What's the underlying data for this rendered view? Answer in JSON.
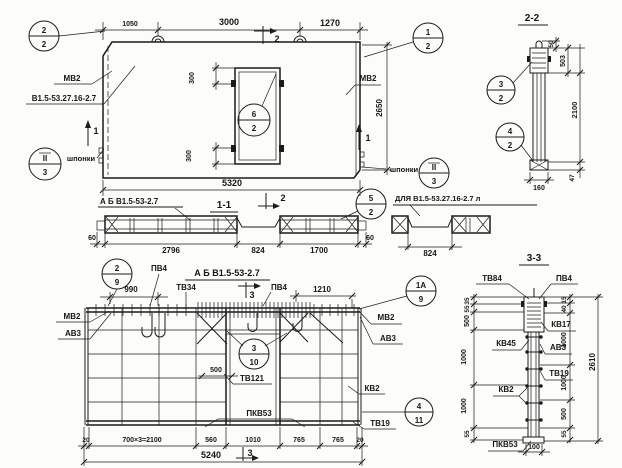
{
  "top_view": {
    "balloons": {
      "corner_left": {
        "num": "2",
        "sheet": "2"
      },
      "corner_right": {
        "num": "1",
        "sheet": "2"
      },
      "door": {
        "num": "6",
        "sheet": "2"
      },
      "key_left": {
        "num": "II",
        "sheet": "3"
      },
      "key_right": {
        "num": "II",
        "sheet": "3"
      }
    },
    "dims": {
      "seg1": "1050",
      "seg2": "3000",
      "seg3": "1270",
      "height": "2650",
      "total": "5320",
      "door_top": "300",
      "door_bottom": "300"
    },
    "labels": {
      "mark_left": "МВ2",
      "series_left": "В1.5-53.27.16-2.7",
      "mark_right": "МВ2",
      "keys_left": "шпонки",
      "keys_right": "шпонки"
    },
    "markers": {
      "sec2_top": "2",
      "sec2_bottom": "2",
      "sec1_left": "1",
      "sec1_right": "1"
    }
  },
  "section22": {
    "title": "2-2",
    "balloons": {
      "upper": {
        "num": "3",
        "sheet": "2"
      },
      "lower": {
        "num": "4",
        "sheet": "2"
      }
    },
    "dims": {
      "d50": "50",
      "d503": "503",
      "d2100": "2100",
      "d47": "47",
      "d160": "160"
    }
  },
  "section11": {
    "title": "1-1",
    "label": "А Б В1.5-53-2.7",
    "balloon": {
      "num": "5",
      "sheet": "2"
    },
    "dims": {
      "left60": "60",
      "seg1": "2796",
      "seg2": "824",
      "seg3": "1700",
      "right60": "60"
    },
    "variant": {
      "label": "ДЛЯ В1.5-53.27.16-2.7 л",
      "dim824": "824"
    }
  },
  "plan": {
    "title": "А Б В1.5-53-2.7",
    "balloons": {
      "tl": {
        "num": "2",
        "sheet": "9"
      },
      "tr": {
        "num": "1А",
        "sheet": "9"
      },
      "mid": {
        "num": "3",
        "sheet": "10"
      },
      "right": {
        "num": "4",
        "sheet": "11"
      }
    },
    "labels": {
      "pv4_left": "ПВ4",
      "tv34": "ТВ34",
      "pv4_right": "ПВ4",
      "mv2_left": "МВ2",
      "av3_left": "АВ3",
      "mv2_right": "МВ2",
      "av3_right": "АВ3",
      "kv2": "КВ2",
      "tv19": "ТВ19",
      "tv121": "ТВ121",
      "pkv53": "ПКВ53"
    },
    "dims": {
      "d990": "990",
      "d1210": "1210",
      "d500": "500",
      "row": [
        "20",
        "700×3=2100",
        "560",
        "1010",
        "765",
        "765",
        "20"
      ],
      "total": "5240"
    },
    "markers": {
      "sec3_top": "3",
      "sec3_bottom": "3"
    }
  },
  "section33": {
    "title": "3-3",
    "labels": {
      "tv84": "ТВ84",
      "pv4": "ПВ4",
      "kv17": "КВ17",
      "av3": "АВ3",
      "kv45": "КВ45",
      "kv2": "КВ2",
      "tv19": "ТВ19",
      "pkv53": "ПКВ53"
    },
    "dims_left": [
      "35",
      "55",
      "500",
      "1000",
      "1000",
      "55"
    ],
    "dims_right": [
      "15",
      "40",
      "1000",
      "1000",
      "500",
      "55"
    ],
    "dims": {
      "total": "2610",
      "base": "100"
    }
  }
}
